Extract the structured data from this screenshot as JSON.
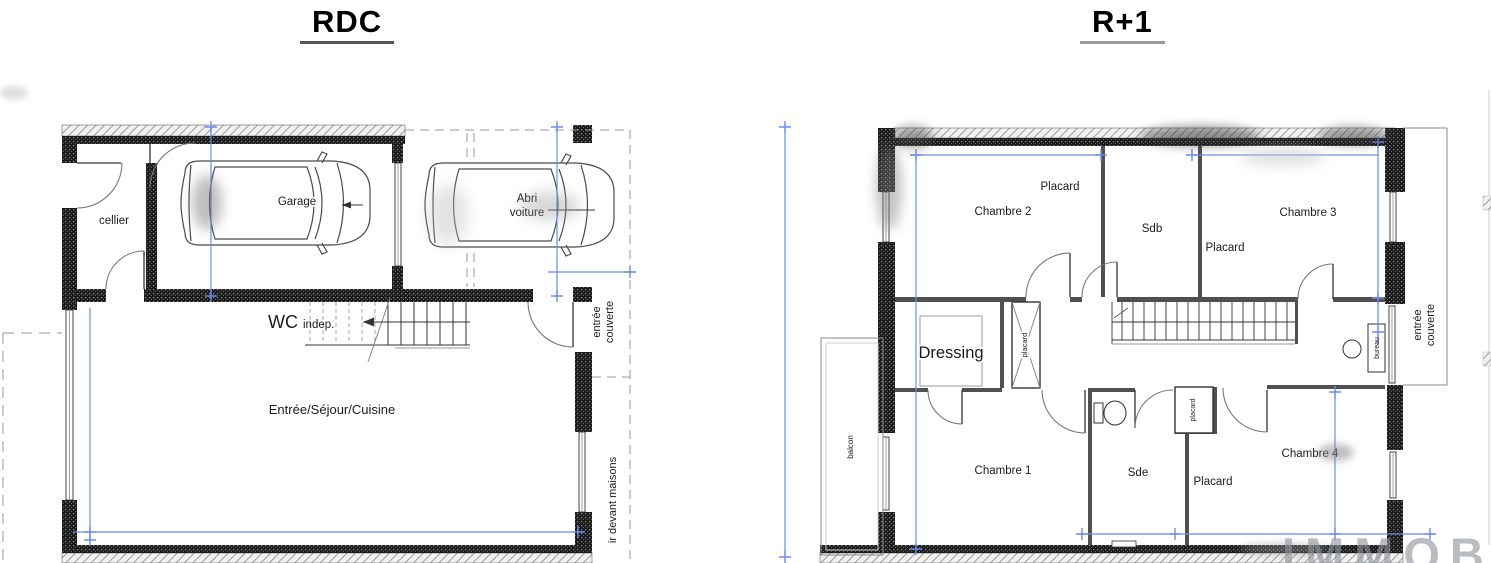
{
  "titles": {
    "left": "RDC",
    "right": "R+1"
  },
  "watermark": "IMMOB",
  "rdc": {
    "cellier": "cellier",
    "garage": "Garage",
    "abri_line1": "Abri",
    "abri_line2": "voiture",
    "wc": "WC",
    "wc_suffix": "indep.",
    "sejour": "Entrée/Séjour/Cuisine",
    "entree_couverte_line1": "entrée",
    "entree_couverte_line2": "couverte",
    "trottoir": "ir devant maisons"
  },
  "r1": {
    "chambre2": "Chambre 2",
    "placard_chambre2": "Placard",
    "sdb": "Sdb",
    "chambre3": "Chambre 3",
    "placard_chambre3": "Placard",
    "dressing": "Dressing",
    "placard_couloir": "placard",
    "chambre1": "Chambre 1",
    "sde": "Sde",
    "placard_sde": "placard",
    "placard_chambre4": "Placard",
    "chambre4": "Chambre 4",
    "bureau": "bureau",
    "balcon": "balcon",
    "entree_couverte_line1": "entrée",
    "entree_couverte_line2": "couverte"
  },
  "colors": {
    "dimension_line": "#6b8ceb",
    "wall_dark": "#1b1b1b",
    "hatch": "#8d8d8d",
    "watermark_gray": "#8f969d"
  }
}
